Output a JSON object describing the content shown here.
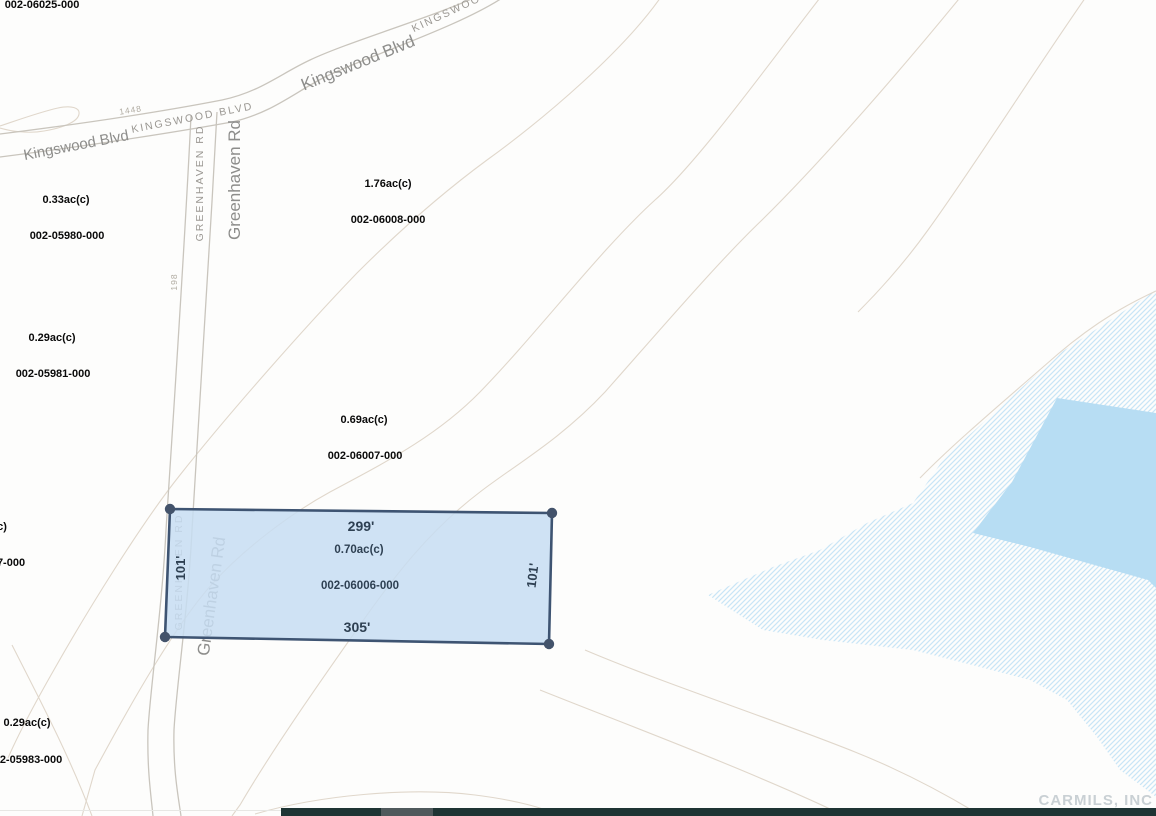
{
  "map": {
    "background": "#fdfdfc",
    "road_color": "#c9c5bd",
    "contour_color": "#ddd3c6",
    "roads": [
      {
        "name": "kingswood-blvd-upper-edge",
        "d": "M0,134 C80,124 160,112 222,100 C260,92 280,74 310,60 C350,41 440,15 482,-6"
      },
      {
        "name": "kingswood-blvd-lower-edge",
        "d": "M0,157 C85,146 165,134 232,122 C272,113 295,92 325,77 C365,57 465,25 508,-6"
      },
      {
        "name": "greenhaven-rd-left-edge",
        "d": "M191,116 C184,260 173,420 166,530 C162,610 150,690 148,730 C147,770 151,795 153,816"
      },
      {
        "name": "greenhaven-rd-right-edge",
        "d": "M217,112 C209,260 199,420 192,530 C188,610 176,690 174,730 C173,770 178,795 181,816"
      }
    ],
    "contours": [
      "M663,-6 C625,50 545,118 487,160 C430,202 385,245 357,273 C305,327 230,412 180,475 C140,525 85,615 55,668 C35,703 18,735 8,758",
      "M823,-6 C770,62 700,160 655,200 C600,250 540,330 480,392 C435,438 380,465 330,492 C290,514 245,548 213,583 C175,625 130,705 95,770 L82,816",
      "M963,-6 C905,65 825,158 762,220 C718,262 660,330 605,392 C560,440 515,465 480,492 C430,530 395,575 360,625 C330,668 275,745 240,805 L232,816",
      "M1088,-6 C1035,70 975,165 928,230 C905,262 880,290 858,312",
      "M920,478 C955,442 1010,396 1058,354 C1098,320 1130,303 1156,291",
      "M585,650 C660,682 770,718 855,752 C905,772 945,794 975,812",
      "M540,690 C610,718 690,748 760,778 C800,795 825,806 840,814",
      "M255,814 C320,795 410,787 475,795 C515,800 545,808 560,816",
      "M0,126 C18,120 40,112 58,108 C72,105 80,108 79,114 C78,122 62,128 44,131 C28,134 10,131 0,128",
      "M12,645 C40,700 70,757 92,816"
    ],
    "water": {
      "pond_color": "#b7ddf3",
      "hatch_line_color": "#c9e5f6",
      "hatch_points": "1156,290 1060,353 997,410 945,457 913,503 867,523 820,550 773,567 708,595 763,630 823,640 913,650 980,667 1030,680 1067,700 1097,737 1120,770 1147,790 1156,797",
      "pond_points": "1057,398 1156,413 1156,588 1148,580 1030,547 973,533 1012,482"
    },
    "labels_under": [
      {
        "text": "GREENHAVEN  RD",
        "x": 182,
        "y": 572,
        "rot": -90,
        "cls": "caps",
        "fs": 10.5,
        "name": "greenhaven-rd-caps-label-south"
      },
      {
        "text": "Greenhaven Rd",
        "x": 217,
        "y": 597,
        "rot": -82,
        "cls": "road",
        "fs": 17,
        "name": "greenhaven-rd-label-south"
      }
    ],
    "labels": [
      {
        "text": "002-06025-000",
        "x": 42,
        "y": 8,
        "rot": 0,
        "cls": "black",
        "fs": 11,
        "name": "parcel-id-002-06025-000"
      },
      {
        "text": "Kingswood Blvd",
        "x": 77,
        "y": 150,
        "rot": -11,
        "cls": "road",
        "fs": 15,
        "name": "kingswood-blvd-label-west"
      },
      {
        "text": "KINGSWOOD  BLVD",
        "x": 193,
        "y": 121,
        "rot": -11,
        "cls": "caps",
        "fs": 10.5,
        "name": "kingswood-blvd-caps-label"
      },
      {
        "text": "1448",
        "x": 131,
        "y": 113,
        "rot": -9,
        "cls": "tiny",
        "fs": 8.5,
        "name": "address-number-1448"
      },
      {
        "text": "Kingswood Blvd",
        "x": 360,
        "y": 68,
        "rot": -22,
        "cls": "road",
        "fs": 17,
        "name": "kingswood-blvd-label-main"
      },
      {
        "text": "KINGSWOOD   BLVD",
        "x": 470,
        "y": 6,
        "rot": -25,
        "cls": "caps",
        "fs": 10.5,
        "name": "kingswood-blvd-caps-label-northeast"
      },
      {
        "text": "GREENHAVEN  RD",
        "x": 203,
        "y": 183,
        "rot": -90,
        "cls": "caps",
        "fs": 10.5,
        "name": "greenhaven-rd-caps-label-north"
      },
      {
        "text": "Greenhaven Rd",
        "x": 240,
        "y": 180,
        "rot": -90,
        "cls": "road",
        "fs": 17,
        "name": "greenhaven-rd-label-north"
      },
      {
        "text": "0.33ac(c)",
        "x": 66,
        "y": 203,
        "rot": 0,
        "cls": "black",
        "fs": 11,
        "name": "acreage-002-05980"
      },
      {
        "text": "002-05980-000",
        "x": 67,
        "y": 239,
        "rot": 0,
        "cls": "black",
        "fs": 11,
        "name": "parcel-id-002-05980-000"
      },
      {
        "text": "198",
        "x": 177,
        "y": 282,
        "rot": -90,
        "cls": "tiny",
        "fs": 8.5,
        "name": "address-number-198"
      },
      {
        "text": "1.76ac(c)",
        "x": 388,
        "y": 187,
        "rot": 0,
        "cls": "black",
        "fs": 11,
        "name": "acreage-002-06008"
      },
      {
        "text": "002-06008-000",
        "x": 388,
        "y": 223,
        "rot": 0,
        "cls": "black",
        "fs": 11,
        "name": "parcel-id-002-06008-000"
      },
      {
        "text": "0.29ac(c)",
        "x": 52,
        "y": 341,
        "rot": 0,
        "cls": "black",
        "fs": 11,
        "name": "acreage-002-05981"
      },
      {
        "text": "002-05981-000",
        "x": 53,
        "y": 377,
        "rot": 0,
        "cls": "black",
        "fs": 11,
        "name": "parcel-id-002-05981-000"
      },
      {
        "text": "0.69ac(c)",
        "x": 364,
        "y": 423,
        "rot": 0,
        "cls": "black",
        "fs": 11,
        "name": "acreage-002-06007"
      },
      {
        "text": "002-06007-000",
        "x": 365,
        "y": 459,
        "rot": 0,
        "cls": "black",
        "fs": 11,
        "name": "parcel-id-002-06007-000"
      },
      {
        "text": "c)",
        "x": 2,
        "y": 530,
        "rot": 0,
        "cls": "black",
        "fs": 11,
        "name": "acreage-clipped-west"
      },
      {
        "text": "7-000",
        "x": 11,
        "y": 566,
        "rot": 0,
        "cls": "black",
        "fs": 11,
        "name": "parcel-id-clipped-west"
      },
      {
        "text": "0.29ac(c)",
        "x": 27,
        "y": 726,
        "rot": 0,
        "cls": "black",
        "fs": 11,
        "name": "acreage-002-05983"
      },
      {
        "text": "2-05983-000",
        "x": 31,
        "y": 763,
        "rot": 0,
        "cls": "black",
        "fs": 11,
        "name": "parcel-id-002-05983-000"
      }
    ],
    "selected_parcel": {
      "parcel_id": "002-06006-000",
      "acreage": "0.70ac(c)",
      "points": "170,509 552,513 549,644 165,637",
      "corners": [
        [
          170,
          509
        ],
        [
          552,
          513
        ],
        [
          549,
          644
        ],
        [
          165,
          637
        ]
      ],
      "fill": "#c7ddf2",
      "fill_opacity": 0.85,
      "stroke": "#3e5472",
      "dot_color": "#43536b",
      "labels": [
        {
          "text": "299'",
          "x": 361,
          "y": 531,
          "rot": 0,
          "fs": 14,
          "name": "dimension-top-299ft"
        },
        {
          "text": "0.70ac(c)",
          "x": 359,
          "y": 553,
          "rot": 0,
          "fs": 11.5,
          "name": "selected-parcel-acreage"
        },
        {
          "text": "002-06006-000",
          "x": 360,
          "y": 589,
          "rot": 0,
          "fs": 11.5,
          "name": "selected-parcel-id"
        },
        {
          "text": "305'",
          "x": 357,
          "y": 632,
          "rot": 0,
          "fs": 14,
          "name": "dimension-bottom-305ft"
        },
        {
          "text": "101'",
          "x": 537,
          "y": 576,
          "rot": -83,
          "fs": 13,
          "name": "dimension-right-101ft"
        },
        {
          "text": "101'",
          "x": 185,
          "y": 568,
          "rot": -90,
          "fs": 13,
          "name": "dimension-left-101ft"
        }
      ]
    }
  },
  "scrollbar": {
    "track_color": "#1e3434",
    "thumb_color": "#4f595c"
  },
  "watermark": {
    "text": "CARMILS, INC"
  }
}
